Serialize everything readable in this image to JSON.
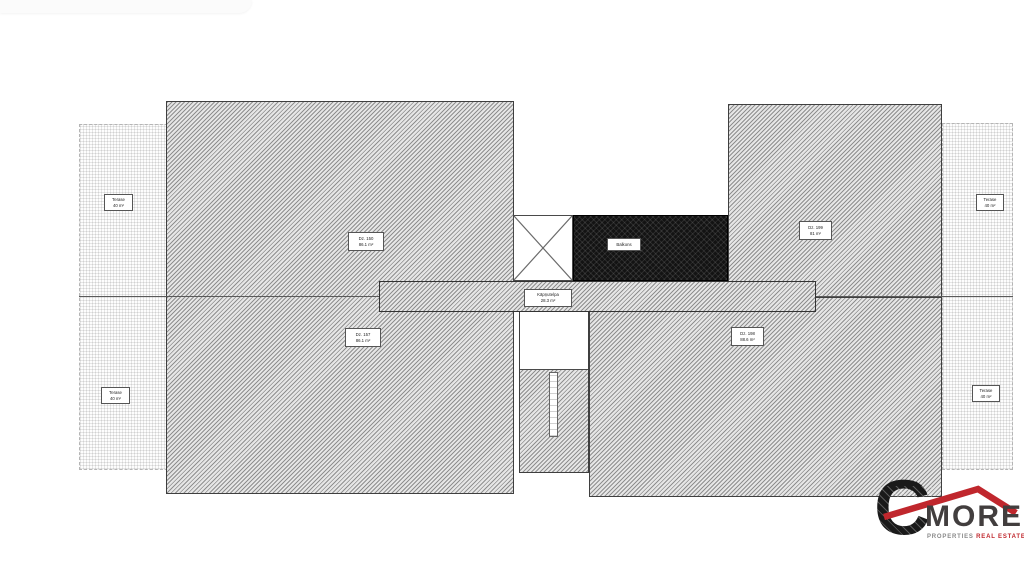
{
  "document": {
    "type": "roof-terrace floor plan drawing",
    "background": "#ffffff"
  },
  "plan": {
    "labels": {
      "terrace_top_left": {
        "line1": "Terase",
        "line2": "40 m²"
      },
      "terrace_bottom_left": {
        "line1": "Terase",
        "line2": "40 m²"
      },
      "terrace_top_right": {
        "line1": "Terase",
        "line2": "40 m²"
      },
      "terrace_bottom_right": {
        "line1": "Terase",
        "line2": "40 m²"
      },
      "roof_upper_left": {
        "line1": "Dz. 150",
        "line2": "86.1 m²"
      },
      "roof_lower_left": {
        "line1": "Dz. 157",
        "line2": "86.1 m²"
      },
      "roof_upper_right": {
        "line1": "Dz. 199",
        "line2": "81 m²"
      },
      "roof_lower_right": {
        "line1": "Dz. 198",
        "line2": "88.6 m²"
      },
      "stair_corridor": {
        "line1": "Kāpņutelpa",
        "line2": "28.3 m²"
      },
      "balcony": {
        "line1": "Balkons"
      }
    }
  },
  "logo": {
    "letter": "C",
    "word": "MORE",
    "tagline_gray": "PROPERTIES",
    "tagline_red": "REAL ESTATES"
  },
  "colors": {
    "accent_red": "#c0272d",
    "logo_dark": "#1a1a1a",
    "logo_gray": "#8a8a8a",
    "hatch_border": "#3f3f3f",
    "balcony_fill": "#131313"
  }
}
